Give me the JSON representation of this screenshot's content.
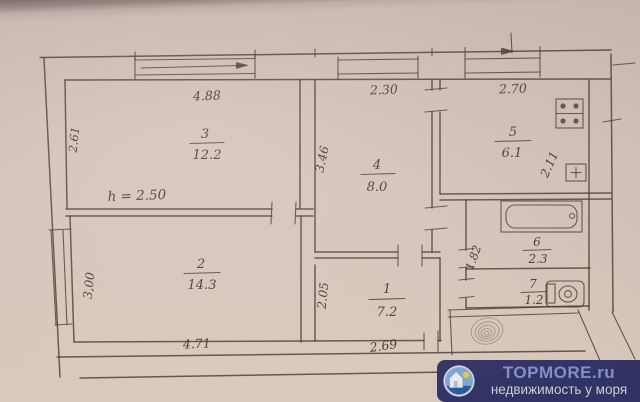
{
  "plan": {
    "ceiling_height_label": "h = 2.50",
    "corridor_dim": "1.82",
    "rooms": {
      "room3": {
        "number": "3",
        "area": "12.2",
        "top_dim": "4.88",
        "side_dim": "2.61"
      },
      "room4": {
        "number": "4",
        "area": "8.0",
        "top_dim": "2.30",
        "side_dim": "3.46"
      },
      "room5": {
        "number": "5",
        "area": "6.1",
        "top_dim": "2.70",
        "side_dim": "2.11"
      },
      "room2": {
        "number": "2",
        "area": "14.3",
        "bottom_dim": "4.71",
        "side_dim": "3,00"
      },
      "room1": {
        "number": "1",
        "area": "7.2",
        "bottom_dim": "2.69",
        "side_dim": "2.05"
      },
      "room6": {
        "number": "6",
        "area": "2.3"
      },
      "room7": {
        "number": "7",
        "area": "1.2"
      }
    },
    "icons": {
      "bathtub": "bathtub-icon",
      "toilet": "toilet-icon",
      "stove": "stove-icon",
      "sink": "sink-icon",
      "stamp": "spiral-stamp-icon",
      "window_arrow": "arrow-right-icon"
    }
  },
  "watermark": {
    "brand": "TOPMORE.ru",
    "tagline": "недвижимость у моря",
    "logo": "house-and-sun-logo-icon"
  },
  "colors": {
    "paper": "#d6c5bd",
    "ink": "#43382e",
    "watermark_bg": "#34366b",
    "brand_text": "#8c95d6",
    "tagline_text": "#dcd8e0"
  }
}
